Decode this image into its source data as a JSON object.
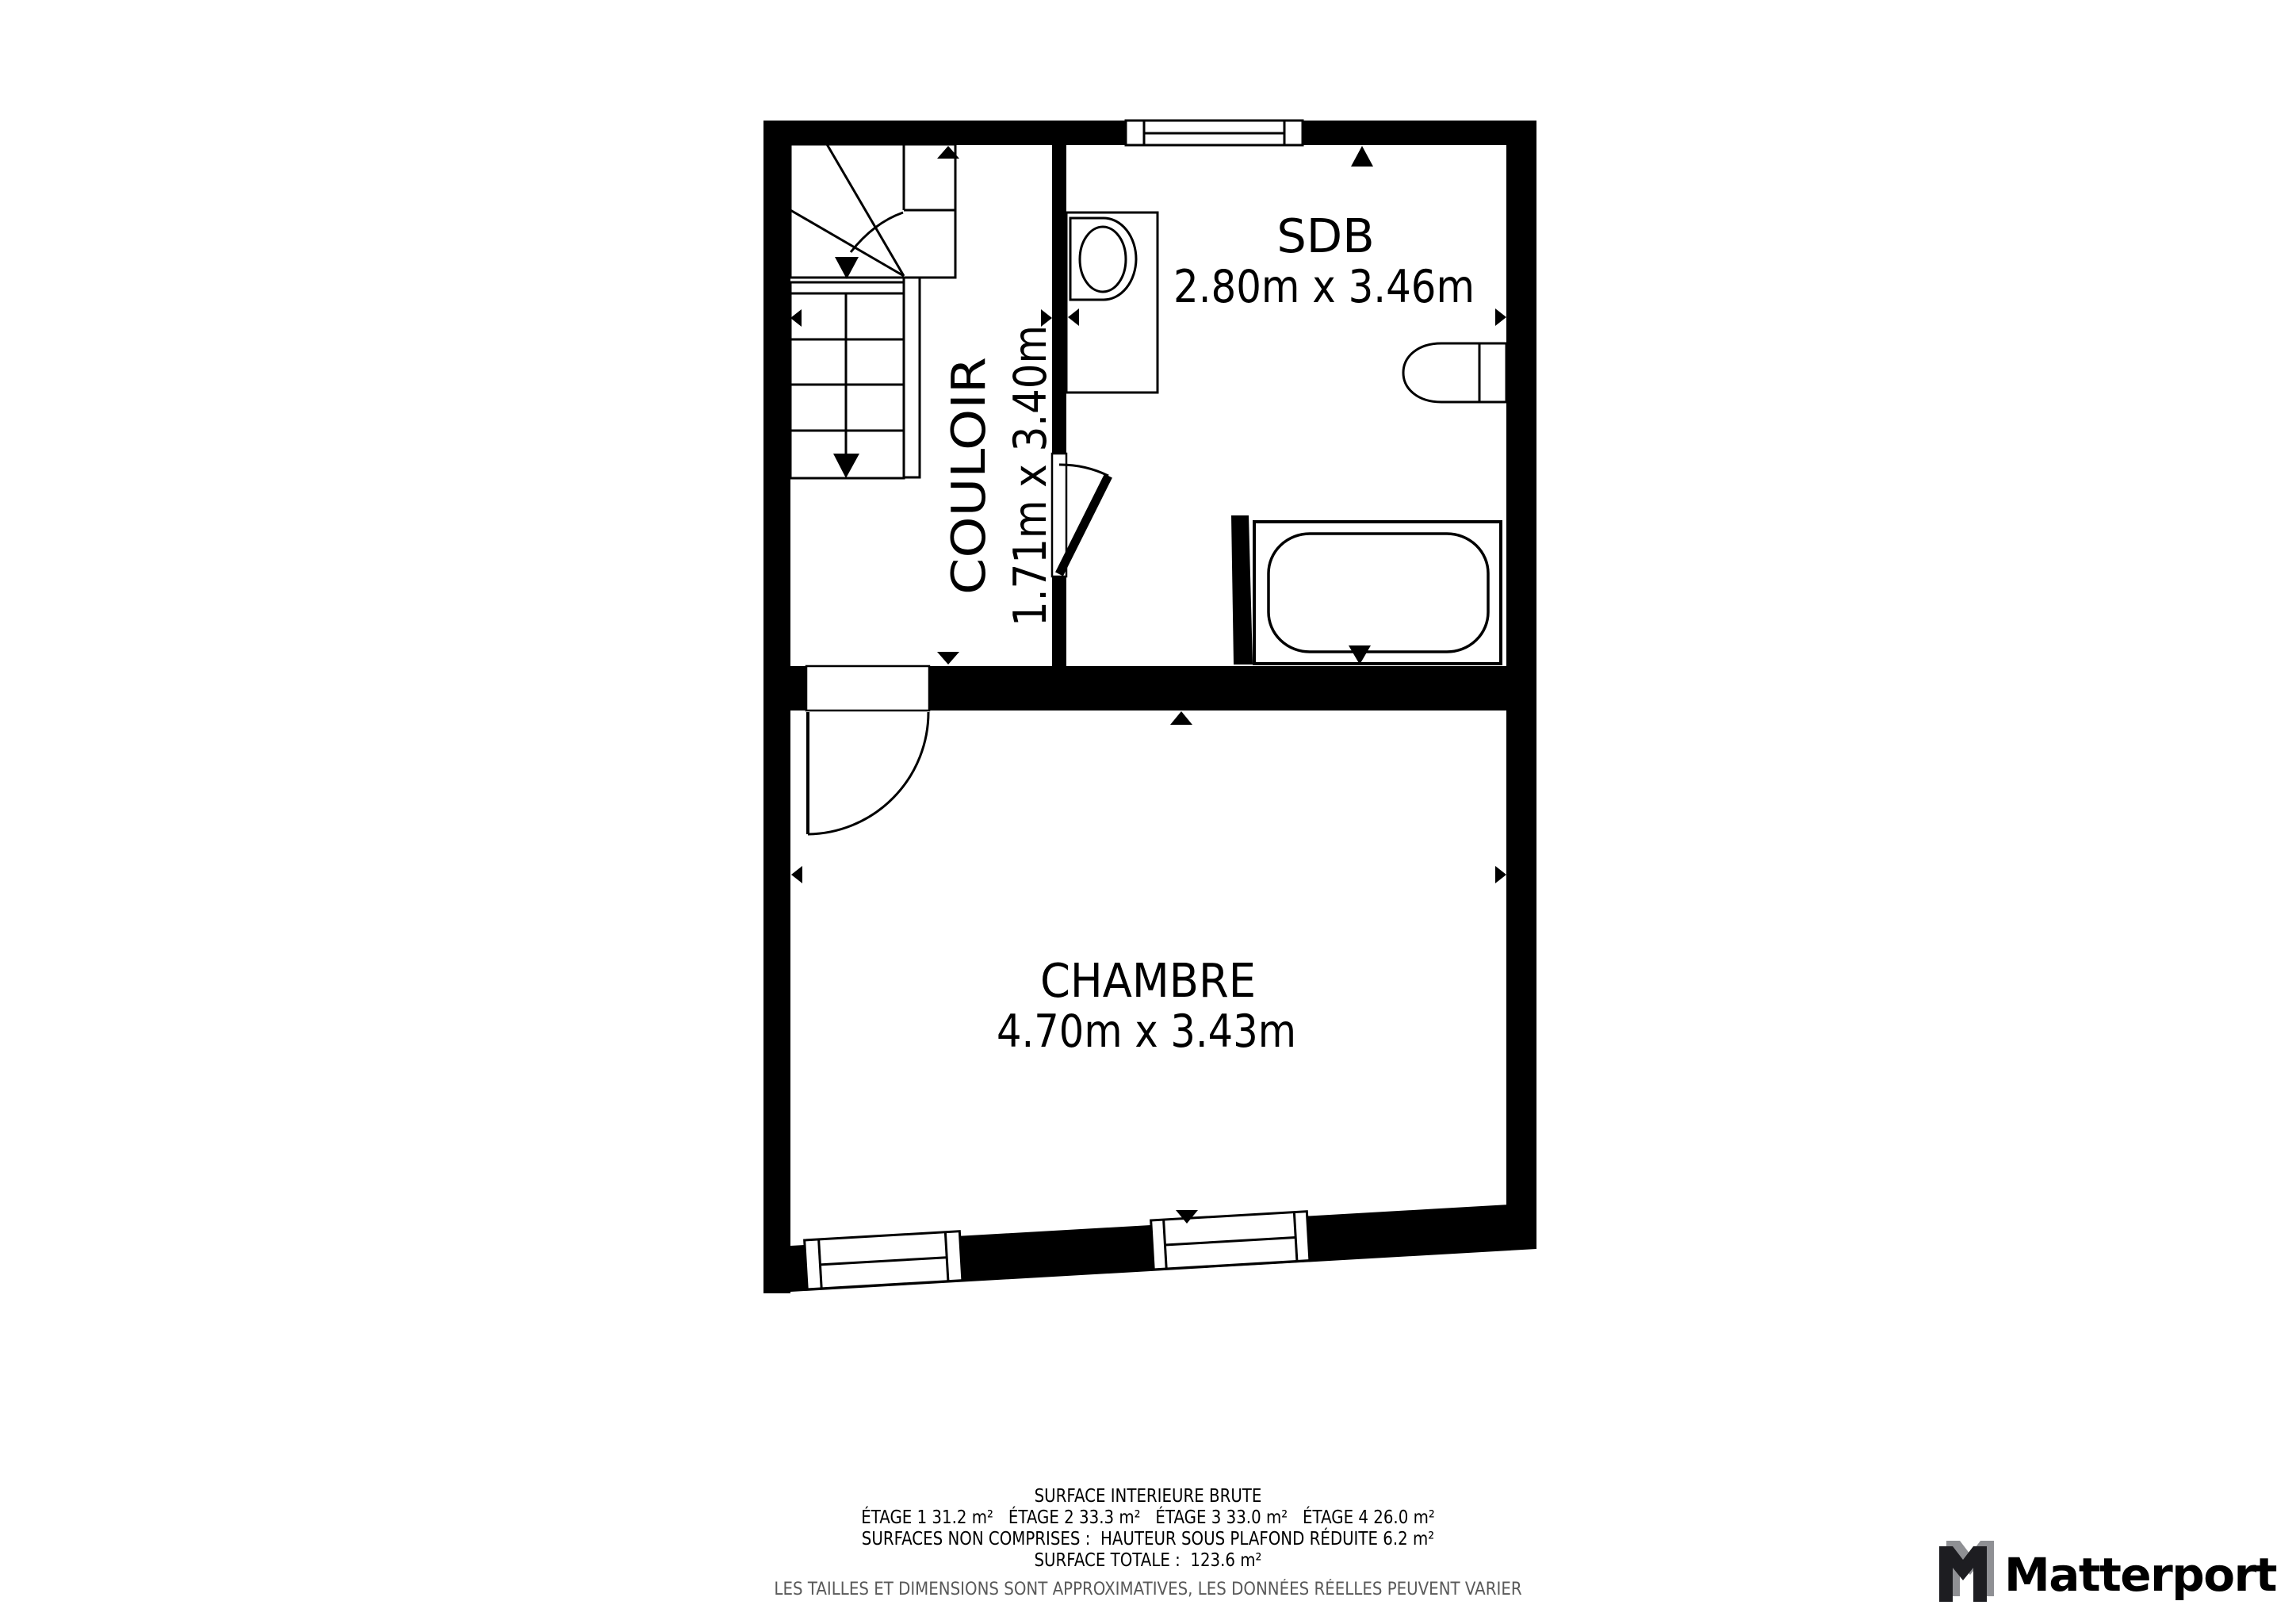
{
  "plan": {
    "wall_color": "#000000",
    "floor_color": "#ffffff",
    "rooms": [
      {
        "id": "couloir",
        "name": "COULOIR",
        "dimensions": "1.71m x 3.40m"
      },
      {
        "id": "sdb",
        "name": "SDB",
        "dimensions": "2.80m x 3.46m"
      },
      {
        "id": "chambre",
        "name": "CHAMBRE",
        "dimensions": "4.70m x 3.43m"
      }
    ],
    "icons": [
      "staircase-icon",
      "sink-icon",
      "toilet-icon",
      "bathtub-icon",
      "door-swing-icon",
      "window-icon",
      "dimension-arrow-icon"
    ]
  },
  "footer": {
    "title": "SURFACE INTERIEURE BRUTE",
    "floors": "ÉTAGE 1 31.2 m²   ÉTAGE 2 33.3 m²   ÉTAGE 3 33.0 m²   ÉTAGE 4 26.0 m²",
    "excluded": "SURFACES NON COMPRISES :  HAUTEUR SOUS PLAFOND RÉDUITE 6.2 m²",
    "total": "SURFACE TOTALE :  123.6 m²",
    "disclaimer": "LES TAILLES ET DIMENSIONS SONT APPROXIMATIVES, LES DONNÉES RÉELLES PEUVENT VARIER",
    "disclaimer_color": "#595959"
  },
  "logo": {
    "text": "Matterport",
    "text_color": "#1d1d21",
    "mark_gray": "#8f9094",
    "mark_black": "#1d1d21"
  }
}
